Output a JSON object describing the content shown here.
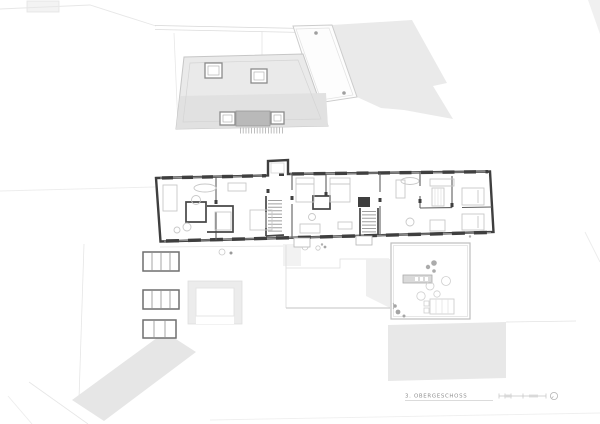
{
  "drawing": {
    "title": "3. OBERGESCHOSS"
  },
  "legend": {
    "scale_bar": {
      "tick_count": 5
    },
    "north_indicator": "circle-symbol"
  },
  "plan": {
    "upper_area": "adjacent building roof plan with skylights and roof hatch",
    "main_area": "third upper floor plan with three apartments, two stair cores",
    "lower_area": "terrace with outdoor furniture, garden slope, three skylight bands"
  },
  "colors": {
    "background": "#ffffff",
    "wall": "#3f3f3f",
    "roof_fill": "#eaeaea",
    "roof_band": "#e1e1e1",
    "terrain_fill": "#eaeaea",
    "slope_fill": "#e6e6e6",
    "terrace_slab": "#e8e8e8",
    "hatch_block": "#b9b9b9",
    "furniture_line": "#c8c8c8",
    "faint_line": "#e0e0e0",
    "label_text": "#8f8f8f"
  }
}
